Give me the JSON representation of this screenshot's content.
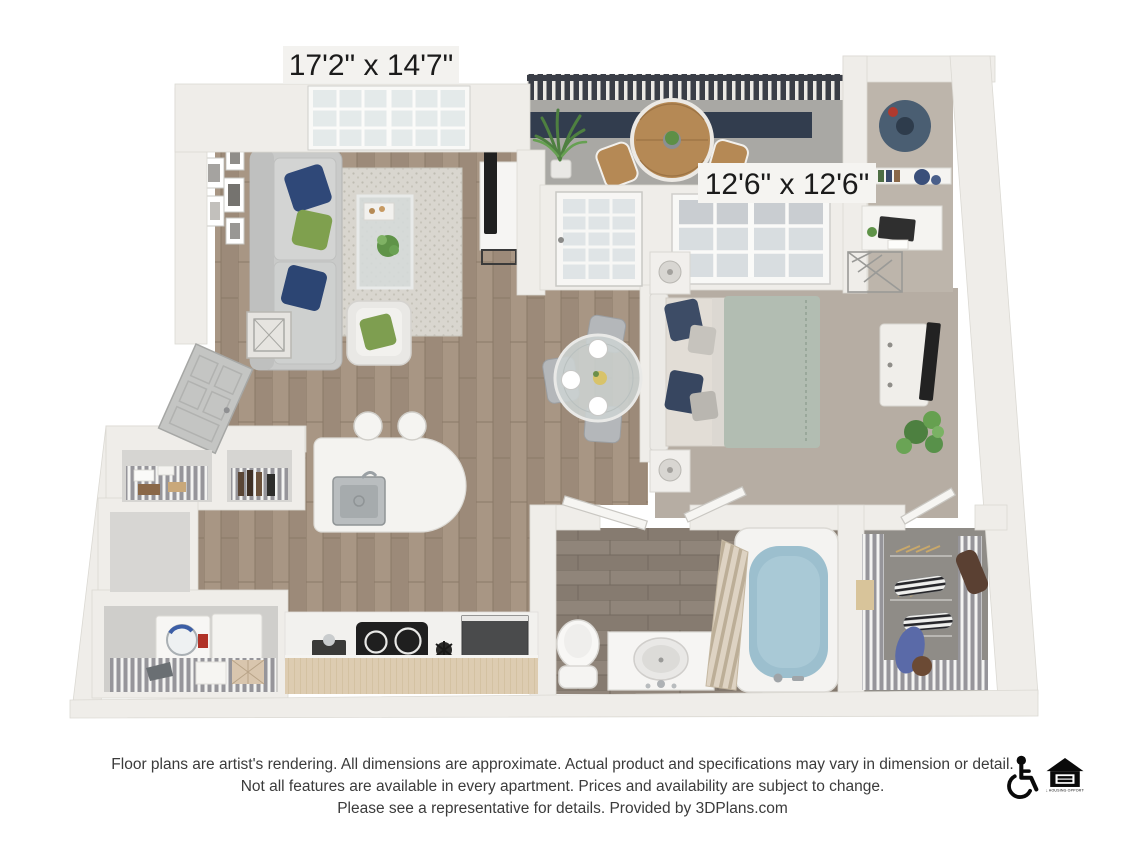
{
  "floor_plan": {
    "living_room": {
      "label": "17'2\" x 14'7\""
    },
    "bedroom": {
      "label": "12'6\" x 12'6\""
    },
    "rooms": [
      "living-room",
      "balcony",
      "dining-area",
      "kitchen",
      "pantry",
      "laundry",
      "entry",
      "bathroom",
      "bedroom",
      "desk-nook",
      "walk-in-closet"
    ]
  },
  "disclaimer": {
    "line1": "Floor plans are artist's rendering. All dimensions are approximate. Actual product and specifications may vary in dimension or detail.",
    "line2": "Not all features are available in every apartment. Prices and availability are subject to change.",
    "line3": "Please see a representative for details. Provided by 3DPlans.com"
  },
  "footer": {
    "icons": [
      {
        "name": "wheelchair-accessible-icon"
      },
      {
        "name": "equal-housing-opportunity-icon"
      }
    ],
    "equal_housing_caption": "EQUAL HOUSING OPPORTUNITY"
  },
  "colors": {
    "wall": "#efede9",
    "wood_floor": "#a29080",
    "bathroom_floor": "#8d8277",
    "bedroom_carpet": "#b6ada3",
    "closet_carpet": "#8f8c87",
    "balcony_concrete": "#a9a8a4",
    "railing_dark": "#3a3e47",
    "pillow_navy": "#2f4878",
    "pillow_green": "#7fa04e",
    "duvet_sage": "#b2bdb2",
    "tub_water": "#9cbfce",
    "cabinet_wood": "#ddccb1",
    "text": "#3b3b3b"
  }
}
